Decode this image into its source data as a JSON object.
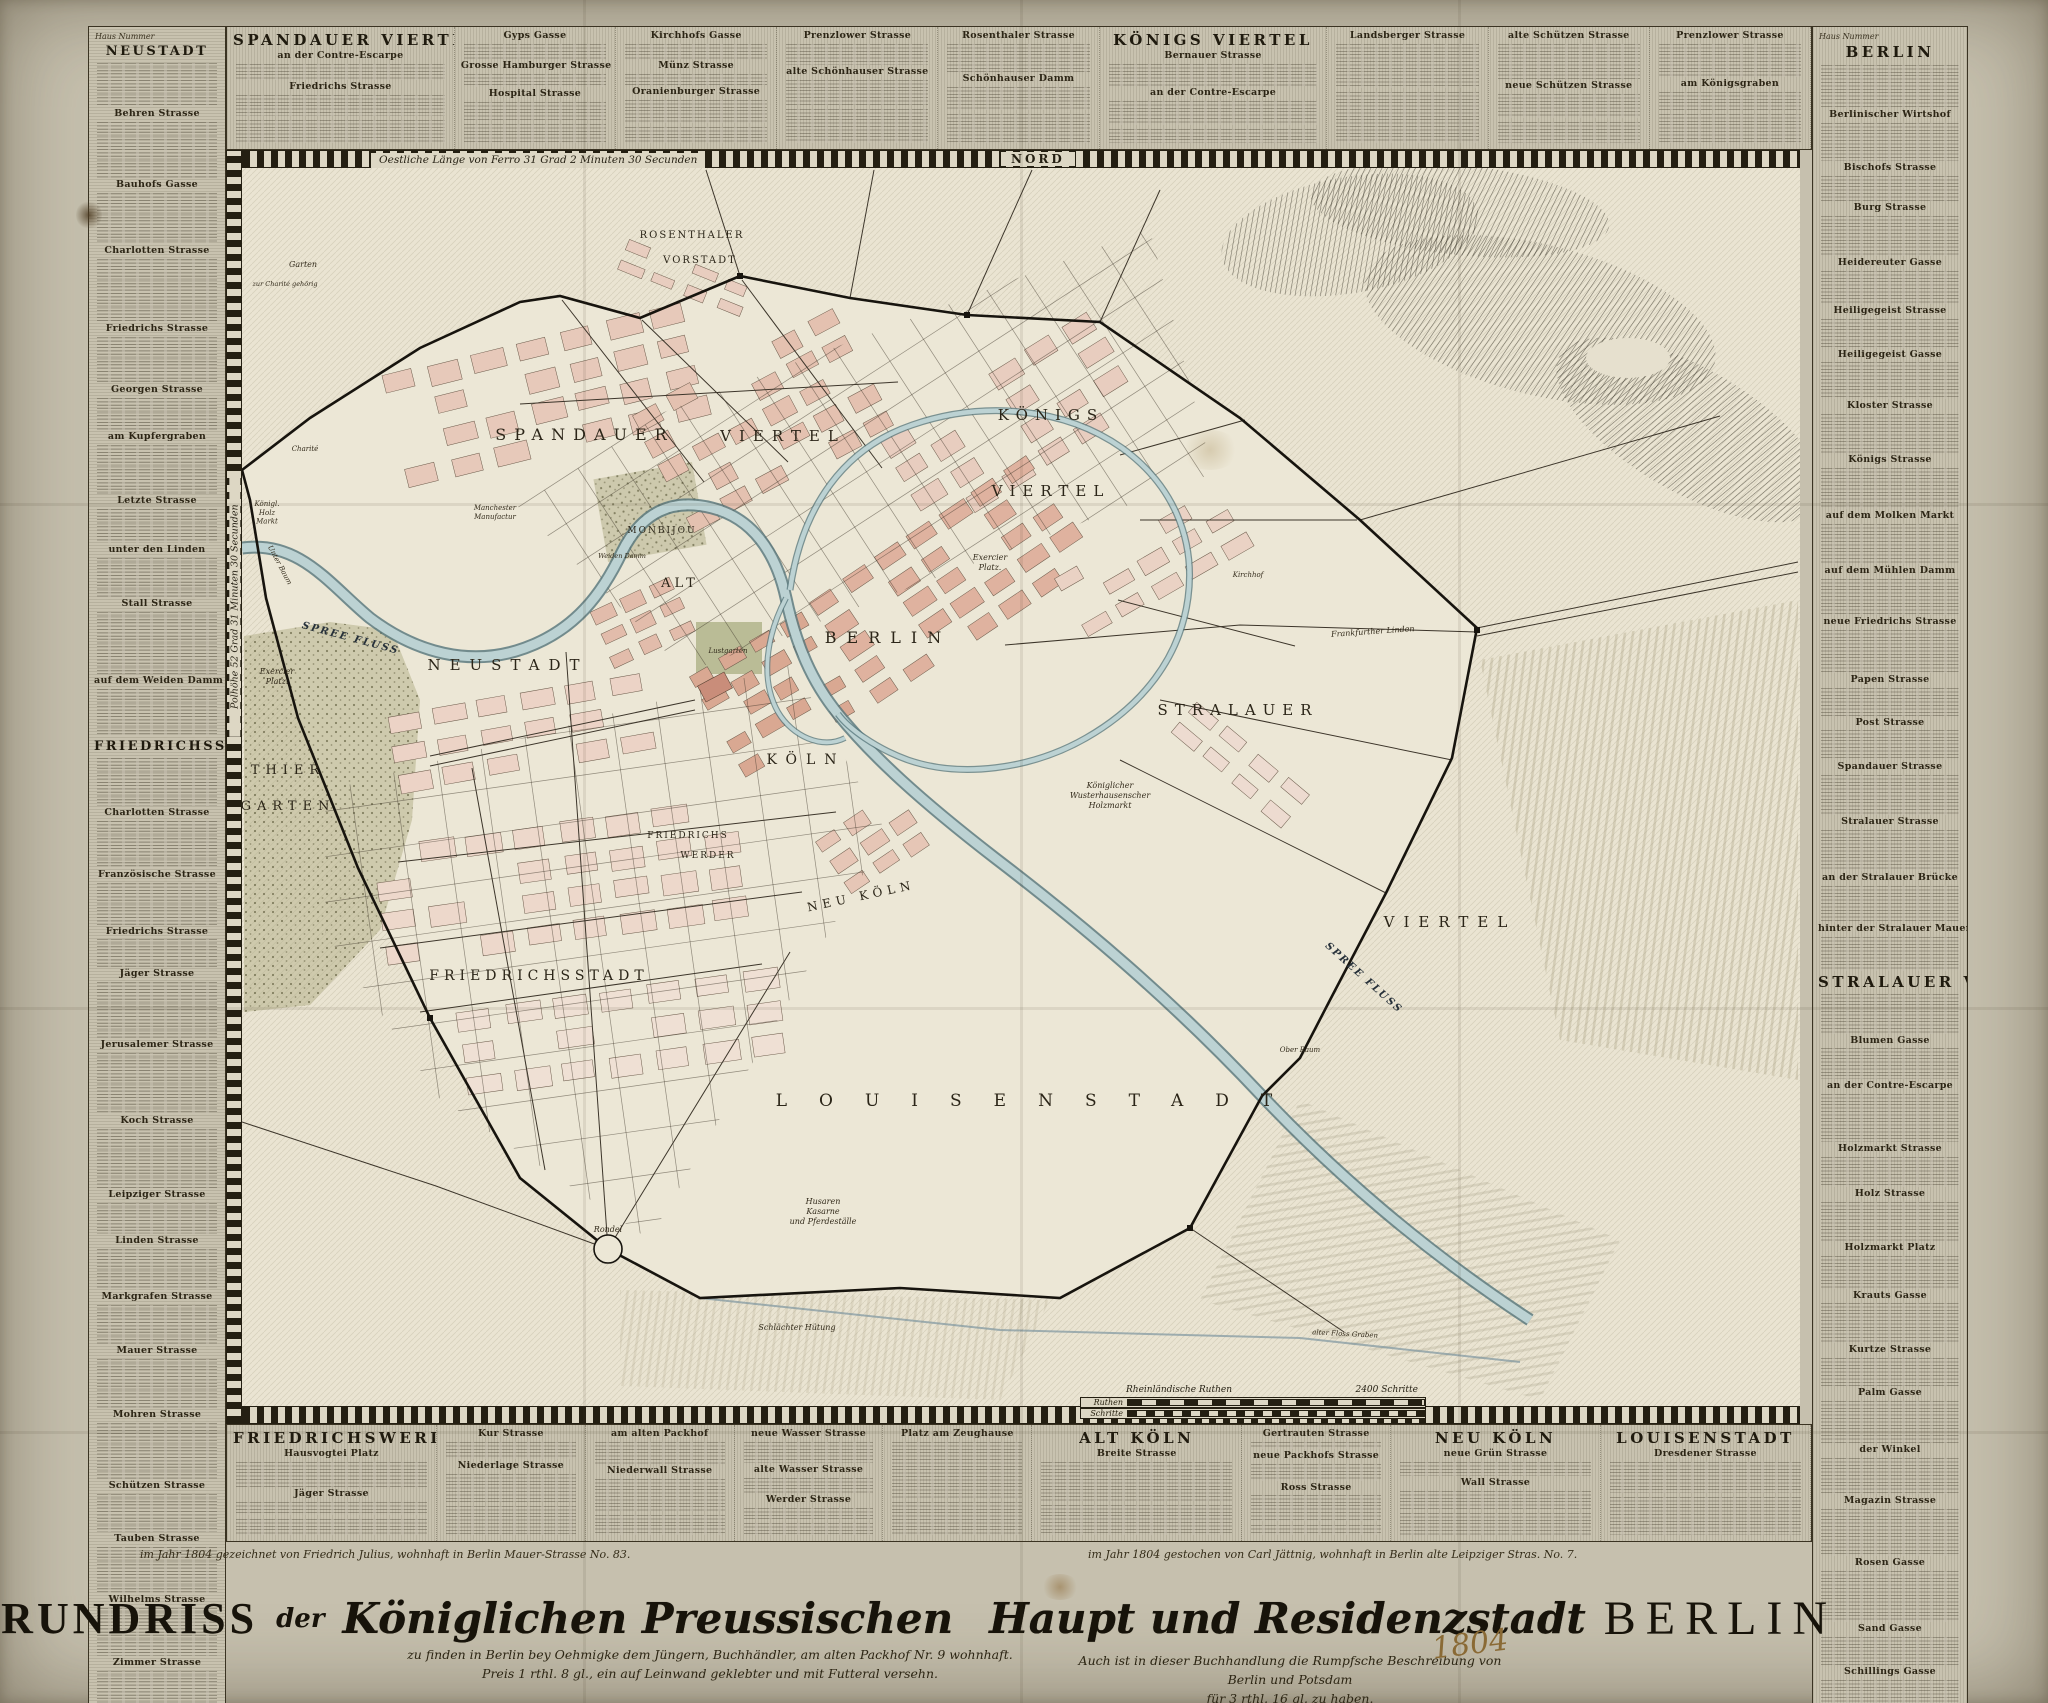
{
  "sheet": {
    "nord": "NORD",
    "longitude_note": "Oestliche Länge von Ferro 31 Grad 2 Minuten 30 Secunden",
    "latitude_note": "Polhöhe 52 Grad 31 Minuten 30 Secunden",
    "year_handwritten": "1804"
  },
  "scalebar": {
    "row1_label": "Ruthen",
    "row2_label": "Schritte",
    "caption1": "Rheinländische Ruthen",
    "caption2": "2400 Schritte"
  },
  "title": {
    "lead": "GRUNDRISS",
    "connector": "der",
    "script_a": "Königlichen Preussischen",
    "script_b": "Haupt und Residenzstadt",
    "city": "BERLIN",
    "imprint_line1": "zu finden in Berlin bey Oehmigke dem Jüngern, Buchhändler, am alten Packhof Nr. 9 wohnhaft.",
    "imprint_line2": "Preis 1 rthl. 8 gl., ein auf Leinwand geklebter und mit Futteral versehn.",
    "imprint_right1": "Auch ist in dieser Buchhandlung die Rumpfsche Beschreibung von Berlin und Potsdam",
    "imprint_right2": "für 3 rthl. 16 gl. zu haben."
  },
  "credits": {
    "left": "im Jahr 1804 gezeichnet von Friedrich Julius, wohnhaft in Berlin Mauer-Strasse No. 83.",
    "right": "im Jahr 1804 gestochen von Carl Jättnig, wohnhaft in Berlin alte Leipziger Stras. No. 7."
  },
  "registers": {
    "left": {
      "note": "Haus Nummer",
      "sections": [
        {
          "header": "NEUSTADT",
          "streets": [
            "Behren Strasse",
            "Bauhofs Gasse",
            "Charlotten Strasse",
            "Friedrichs Strasse",
            "Georgen Strasse",
            "am Kupfergraben",
            "Letzte Strasse",
            "unter den Linden",
            "Stall Strasse",
            "auf dem Weiden Damm"
          ]
        },
        {
          "header": "FRIEDRICHSSTADT",
          "streets": [
            "Charlotten Strasse",
            "Französische Strasse",
            "Friedrichs Strasse",
            "Jäger Strasse",
            "Jerusalemer Strasse",
            "Koch Strasse",
            "Leipziger Strasse",
            "Linden Strasse",
            "Markgrafen Strasse",
            "Mauer Strasse",
            "Mohren Strasse",
            "Schützen Strasse",
            "Tauben Strasse",
            "Wilhelms Strasse",
            "Zimmer Strasse"
          ]
        }
      ]
    },
    "top": {
      "columns": [
        {
          "header": "SPANDAUER VIERTEL",
          "streets": [
            "an der Contre-Escarpe",
            "Friedrichs Strasse"
          ]
        },
        {
          "header": "",
          "streets": [
            "Gyps Gasse",
            "Grosse Hamburger Strasse",
            "Hospital Strasse"
          ]
        },
        {
          "header": "",
          "streets": [
            "Kirchhofs Gasse",
            "Münz Strasse",
            "Oranienburger Strasse"
          ]
        },
        {
          "header": "",
          "streets": [
            "Prenzlower Strasse",
            "alte Schönhauser Strasse"
          ]
        },
        {
          "header": "",
          "streets": [
            "Rosenthaler Strasse",
            "Schönhauser Damm"
          ]
        },
        {
          "header": "KÖNIGS VIERTEL",
          "streets": [
            "Bernauer Strasse",
            "an der Contre-Escarpe"
          ]
        },
        {
          "header": "",
          "streets": [
            "Landsberger Strasse"
          ]
        },
        {
          "header": "",
          "streets": [
            "alte Schützen Strasse",
            "neue Schützen Strasse"
          ]
        },
        {
          "header": "",
          "streets": [
            "Prenzlower Strasse",
            "am Königsgraben"
          ]
        }
      ]
    },
    "right": {
      "note": "Haus Nummer",
      "sections": [
        {
          "header": "BERLIN",
          "streets": [
            "Berlinischer Wirtshof",
            "Bischofs Strasse",
            "Burg Strasse",
            "Heidereuter Gasse",
            "Heiligegeist Strasse",
            "Heiligegeist Gasse",
            "Kloster Strasse",
            "Königs Strasse",
            "auf dem Molken Markt",
            "auf dem Mühlen Damm",
            "neue Friedrichs Strasse",
            "Papen Strasse",
            "Post Strasse",
            "Spandauer Strasse",
            "Stralauer Strasse",
            "an der Stralauer Brücke",
            "hinter der Stralauer Mauer"
          ]
        },
        {
          "header": "STRALAUER VIERTEL",
          "streets": [
            "Blumen Gasse",
            "an der Contre-Escarpe",
            "Holzmarkt Strasse",
            "Holz Strasse",
            "Holzmarkt Platz",
            "Krauts Gasse",
            "Kurtze Strasse",
            "Palm Gasse",
            "der Winkel",
            "Magazin Strasse",
            "Rosen Gasse",
            "Sand Gasse",
            "Schillings Gasse"
          ]
        }
      ]
    },
    "bottom": {
      "columns": [
        {
          "header": "FRIEDRICHSWERDER",
          "streets": [
            "Hausvogtei Platz",
            "Jäger Strasse"
          ]
        },
        {
          "header": "",
          "streets": [
            "Kur Strasse",
            "Niederlage Strasse"
          ]
        },
        {
          "header": "",
          "streets": [
            "am alten Packhof",
            "Niederwall Strasse"
          ]
        },
        {
          "header": "",
          "streets": [
            "neue Wasser Strasse",
            "alte Wasser Strasse",
            "Werder Strasse"
          ]
        },
        {
          "header": "",
          "streets": [
            "Platz am Zeughause"
          ]
        },
        {
          "header": "ALT KÖLN",
          "streets": [
            "Breite Strasse"
          ]
        },
        {
          "header": "",
          "streets": [
            "Gertrauten Strasse",
            "neue Packhofs Strasse",
            "Ross Strasse"
          ]
        },
        {
          "header": "NEU KÖLN",
          "streets": [
            "neue Grün Strasse",
            "Wall Strasse"
          ]
        },
        {
          "header": "LOUISENSTADT",
          "streets": [
            "Dresdener Strasse"
          ]
        }
      ]
    }
  },
  "map_labels": [
    {
      "t": "SPANDAUER",
      "x": 585,
      "y": 440,
      "s": 16,
      "ls": 8,
      "c": "d"
    },
    {
      "t": "VIERTEL",
      "x": 783,
      "y": 441,
      "s": 15,
      "ls": 8,
      "c": "d"
    },
    {
      "t": "KÖNIGS",
      "x": 1051,
      "y": 420,
      "s": 15,
      "ls": 7,
      "c": "d"
    },
    {
      "t": "VIERTEL",
      "x": 1051,
      "y": 496,
      "s": 15,
      "ls": 7,
      "c": "d"
    },
    {
      "t": "ROSENTHALER",
      "x": 692,
      "y": 238,
      "s": 10,
      "ls": 2,
      "c": "d"
    },
    {
      "t": "VORSTADT",
      "x": 700,
      "y": 263,
      "s": 10,
      "ls": 2,
      "c": "d"
    },
    {
      "t": "NEUSTADT",
      "x": 508,
      "y": 670,
      "s": 15,
      "ls": 9,
      "c": "d"
    },
    {
      "t": "ALT",
      "x": 680,
      "y": 587,
      "s": 13,
      "ls": 4,
      "c": "d"
    },
    {
      "t": "BERLIN",
      "x": 888,
      "y": 643,
      "s": 16,
      "ls": 10,
      "c": "d"
    },
    {
      "t": "KÖLN",
      "x": 806,
      "y": 764,
      "s": 14,
      "ls": 9,
      "c": "d"
    },
    {
      "t": "NEU KÖLN",
      "x": 862,
      "y": 900,
      "s": 12,
      "ls": 5,
      "r": -12,
      "c": "d"
    },
    {
      "t": "FRIEDRICHS",
      "x": 688,
      "y": 838,
      "s": 9,
      "ls": 2,
      "c": "d"
    },
    {
      "t": "WERDER",
      "x": 708,
      "y": 858,
      "s": 9,
      "ls": 2,
      "c": "d"
    },
    {
      "t": "FRIEDRICHSSTADT",
      "x": 539,
      "y": 980,
      "s": 14,
      "ls": 5,
      "c": "d"
    },
    {
      "t": "LOUISENSTADT",
      "x": 1040,
      "y": 1106,
      "s": 17,
      "ls": 32,
      "c": "d"
    },
    {
      "t": "STRALAUER",
      "x": 1238,
      "y": 715,
      "s": 15,
      "ls": 7,
      "c": "d"
    },
    {
      "t": "VIERTEL",
      "x": 1450,
      "y": 927,
      "s": 15,
      "ls": 9,
      "c": "d"
    },
    {
      "t": "THIER",
      "x": 288,
      "y": 774,
      "s": 13,
      "ls": 6,
      "c": "d"
    },
    {
      "t": "GARTEN",
      "x": 288,
      "y": 810,
      "s": 13,
      "ls": 6,
      "c": "d"
    },
    {
      "t": "MONBIJOU",
      "x": 662,
      "y": 533,
      "s": 9,
      "ls": 2,
      "c": "d"
    },
    {
      "t": "SPREE FLUSS",
      "x": 350,
      "y": 641,
      "s": 10,
      "ls": 2,
      "r": 15,
      "c": "w"
    },
    {
      "t": "SPREE FLUSS",
      "x": 1362,
      "y": 980,
      "s": 10,
      "ls": 2,
      "r": 42,
      "c": "w"
    },
    {
      "t": "Lustgarten",
      "x": 728,
      "y": 653,
      "s": 7,
      "c": "i"
    },
    {
      "lines": [
        "Exercier",
        "Platz."
      ],
      "x": 277,
      "y": 674,
      "s": 8,
      "c": "i"
    },
    {
      "lines": [
        "Exercier",
        "Platz."
      ],
      "x": 990,
      "y": 560,
      "s": 8,
      "c": "i"
    },
    {
      "t": "Rondel",
      "x": 608,
      "y": 1232,
      "s": 8,
      "c": "i"
    },
    {
      "lines": [
        "Husaren",
        "Kasarne",
        "und Pferdeställe"
      ],
      "x": 823,
      "y": 1204,
      "s": 8,
      "c": "i"
    },
    {
      "t": "Schlächter Hütung",
      "x": 797,
      "y": 1330,
      "s": 8,
      "c": "i"
    },
    {
      "lines": [
        "Königlicher",
        "Wusterhausenscher",
        "Holzmarkt"
      ],
      "x": 1110,
      "y": 788,
      "s": 8,
      "c": "i"
    },
    {
      "lines": [
        "Königl.",
        "Holz",
        "Markt"
      ],
      "x": 267,
      "y": 506,
      "s": 7,
      "c": "i"
    },
    {
      "lines": [
        "Manchester",
        "Manufactur"
      ],
      "x": 495,
      "y": 510,
      "s": 7,
      "c": "i"
    },
    {
      "t": "Kirchhof",
      "x": 1248,
      "y": 577,
      "s": 7,
      "c": "i"
    },
    {
      "t": "Frankfurther Linden",
      "x": 1373,
      "y": 634,
      "s": 8,
      "r": -4,
      "c": "i"
    },
    {
      "t": "Ober Baum",
      "x": 1300,
      "y": 1052,
      "s": 7,
      "c": "i"
    },
    {
      "t": "Unter Baum",
      "x": 278,
      "y": 566,
      "s": 7,
      "r": 62,
      "c": "i"
    },
    {
      "t": "Weiden Damm",
      "x": 622,
      "y": 558,
      "s": 6.5,
      "c": "i"
    },
    {
      "t": "alter Floss Graben",
      "x": 1345,
      "y": 1336,
      "s": 7,
      "r": 3,
      "c": "i"
    },
    {
      "t": "Charité",
      "x": 305,
      "y": 451,
      "s": 7,
      "c": "i"
    },
    {
      "t": "Garten",
      "x": 303,
      "y": 267,
      "s": 8,
      "c": "i"
    },
    {
      "t": "zur Charité gehörig",
      "x": 285,
      "y": 286,
      "s": 6.5,
      "c": "i"
    }
  ]
}
